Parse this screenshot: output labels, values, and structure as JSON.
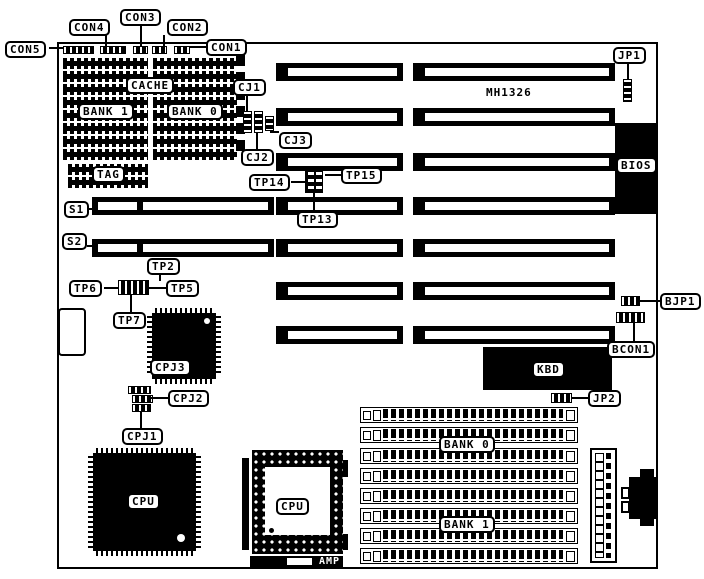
{
  "diagram": {
    "board_model": "MH1326",
    "colors": {
      "ink": "#000000",
      "paper": "#ffffff"
    },
    "labels": {
      "con1": "CON1",
      "con2": "CON2",
      "con3": "CON3",
      "con4": "CON4",
      "con5": "CON5",
      "cache": "CACHE",
      "cache_bank1": "BANK 1",
      "cache_bank0": "BANK 0",
      "tag": "TAG",
      "cj1": "CJ1",
      "cj2": "CJ2",
      "cj3": "CJ3",
      "jp1": "JP1",
      "jp2": "JP2",
      "bios": "BIOS",
      "tp2": "TP2",
      "tp5": "TP5",
      "tp6": "TP6",
      "tp7": "TP7",
      "tp13": "TP13",
      "tp14": "TP14",
      "tp15": "TP15",
      "s1": "S1",
      "s2": "S2",
      "bjp1": "BJP1",
      "bcon1": "BCON1",
      "kbd": "KBD",
      "cpj1": "CPJ1",
      "cpj2": "CPJ2",
      "cpj3": "CPJ3",
      "cpu_qfp": "CPU",
      "cpu_pga": "CPU",
      "amp": "AMP",
      "simm_bank0": "BANK 0",
      "simm_bank1": "BANK 1"
    }
  }
}
